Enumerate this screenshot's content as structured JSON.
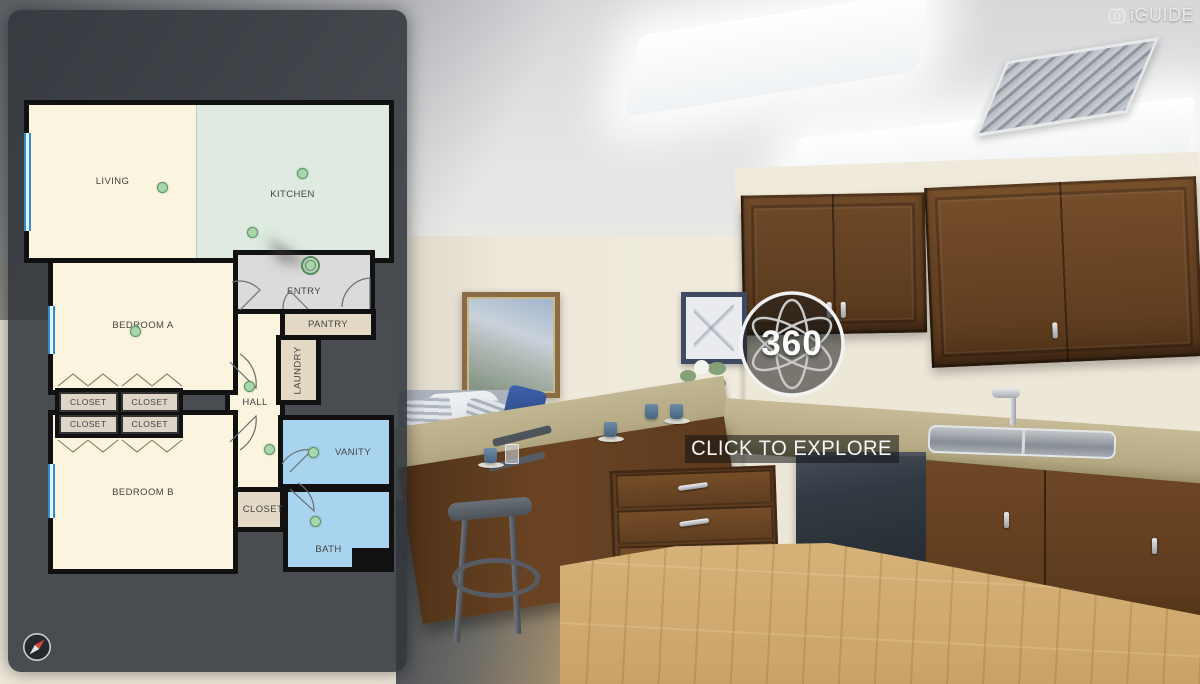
{
  "brand": {
    "name": "iGUIDE"
  },
  "overlay": {
    "badge_text": "360",
    "cta": "CLICK TO EXPLORE"
  },
  "floorplan": {
    "rooms": {
      "living": "LIVING",
      "kitchen": "KITCHEN",
      "entry": "ENTRY",
      "pantry": "PANTRY",
      "laundry": "LAUNDRY",
      "hall": "HALL",
      "bedroom_a": "BEDROOM A",
      "bedroom_b": "BEDROOM B",
      "vanity": "VANITY",
      "bath": "BATH",
      "hall_closet": "CLOSET"
    },
    "closets": [
      "CLOSET",
      "CLOSET",
      "CLOSET",
      "CLOSET"
    ],
    "cameras": [
      {
        "room": "living",
        "x": 154,
        "y": 177
      },
      {
        "room": "kitchen-a",
        "x": 294,
        "y": 163
      },
      {
        "room": "kitchen-b",
        "x": 244,
        "y": 222
      },
      {
        "room": "entry",
        "x": 302,
        "y": 255,
        "ringed": true
      },
      {
        "room": "bedroom-a",
        "x": 127,
        "y": 321
      },
      {
        "room": "hall-a",
        "x": 241,
        "y": 376
      },
      {
        "room": "hall-b",
        "x": 261,
        "y": 439
      },
      {
        "room": "vanity",
        "x": 305,
        "y": 442
      },
      {
        "room": "bath",
        "x": 307,
        "y": 511
      }
    ],
    "colors": {
      "panel": "#32373E",
      "room_cream": "#FBF4DE",
      "room_green": "#DFEBE1",
      "room_blue": "#A9D4EF",
      "room_tan": "#E3D9C5",
      "room_gray": "#DBDBDB",
      "wall": "#111111",
      "camera_dot": "#A9D6AA",
      "camera_dot_border": "#55995E",
      "window_blue": "#2F8ECF"
    }
  }
}
